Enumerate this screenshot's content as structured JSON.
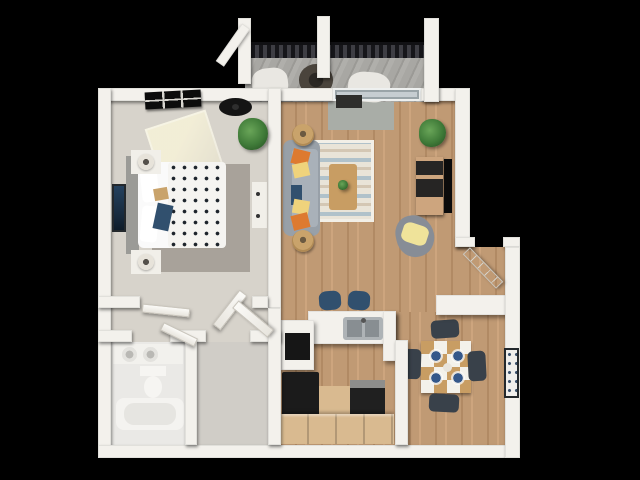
{
  "meta": {
    "type": "3d-floor-plan-render",
    "canvas": {
      "width": 640,
      "height": 480
    },
    "background": "#000000"
  },
  "rooms": [
    {
      "id": "bedroom"
    },
    {
      "id": "living-room"
    },
    {
      "id": "balcony"
    },
    {
      "id": "kitchen"
    },
    {
      "id": "dining-area"
    },
    {
      "id": "entry"
    },
    {
      "id": "hallway"
    },
    {
      "id": "bathroom"
    },
    {
      "id": "closet"
    }
  ],
  "palette": {
    "wall": "#f3f1ec",
    "wood": "#c09a74",
    "wood2": "#b18a64",
    "wood3": "#cda57e",
    "bedroomFloor": "#d7d3cb",
    "bathFloor": "#eae9e6",
    "closetFloor": "#d0cdc7",
    "rugGray": "#a8a29a",
    "sofaGray": "#98a0a8",
    "sofaSeat": "#a9b1b9",
    "accentOrange": "#dd7a30",
    "accentYellow": "#efd37c",
    "navy": "#31506e",
    "tan": "#c9a36b",
    "tableWood": "#c89d63",
    "chairDark": "#39414a",
    "plateBlue": "#35588a",
    "plantGreen": "#3f7a38",
    "applianceBlack": "#1b1b1b",
    "cabinetTan": "#d9ba90",
    "deckGray": "#a3a3a1"
  },
  "shapes": [
    {
      "name": "bedroom-floor",
      "x": 111,
      "y": 101,
      "w": 157,
      "h": 195,
      "fill": "var(--bedroomFloor)",
      "z": 1
    },
    {
      "name": "hallway-floor",
      "x": 111,
      "y": 296,
      "w": 157,
      "h": 46,
      "fill": "var(--bedroomFloor)",
      "z": 1
    },
    {
      "name": "bathroom-floor",
      "x": 111,
      "y": 342,
      "w": 86,
      "h": 103,
      "fill": "var(--bathFloor)",
      "z": 1
    },
    {
      "name": "closet-floor",
      "x": 185,
      "y": 342,
      "w": 96,
      "h": 103,
      "fill": "var(--closetFloor)",
      "z": 1
    },
    {
      "name": "living-room-floor",
      "x": 281,
      "y": 101,
      "w": 174,
      "h": 211,
      "cls": "wood",
      "z": 1
    },
    {
      "name": "kitchen-floor",
      "x": 281,
      "y": 312,
      "w": 114,
      "h": 133,
      "cls": "wood",
      "z": 1
    },
    {
      "name": "dining-floor",
      "x": 395,
      "y": 312,
      "w": 110,
      "h": 133,
      "cls": "wood",
      "z": 1
    },
    {
      "name": "entry-floor",
      "x": 455,
      "y": 247,
      "w": 50,
      "h": 65,
      "cls": "wood",
      "z": 1
    },
    {
      "name": "balcony-deck",
      "x": 245,
      "y": 50,
      "w": 183,
      "h": 52,
      "cls": "deck",
      "z": 1
    },
    {
      "name": "bedroom-rug",
      "x": 152,
      "y": 164,
      "w": 98,
      "h": 108,
      "fill": "var(--rugGray)",
      "z": 2
    },
    {
      "name": "sunlight-patch",
      "x": 152,
      "y": 118,
      "w": 64,
      "h": 58,
      "cls": "sun",
      "rot": -18,
      "z": 2
    },
    {
      "name": "balcony-door-mat",
      "x": 328,
      "y": 102,
      "w": 66,
      "h": 28,
      "fill": "#a9ada7",
      "z": 2
    },
    {
      "name": "living-rug",
      "x": 310,
      "y": 140,
      "w": 64,
      "h": 82,
      "cls": "rug",
      "z": 2
    },
    {
      "name": "balcony-railing",
      "x": 243,
      "y": 42,
      "w": 187,
      "h": 16,
      "cls": "railing",
      "z": 2
    },
    {
      "name": "patio-chair-left",
      "x": 252,
      "y": 68,
      "w": 36,
      "h": 30,
      "fill": "#e9e7e2",
      "rad": "40%",
      "rot": -6,
      "z": 3
    },
    {
      "name": "patio-chair-right",
      "x": 348,
      "y": 72,
      "w": 42,
      "h": 30,
      "fill": "#e9e7e2",
      "rad": "40%",
      "rot": 5,
      "z": 3
    },
    {
      "name": "patio-table",
      "x": 299,
      "y": 64,
      "w": 34,
      "h": 32,
      "cls": "wicker",
      "z": 3
    },
    {
      "name": "bed-headboard",
      "x": 126,
      "y": 156,
      "w": 13,
      "h": 98,
      "fill": "#9b9b97",
      "z": 3
    },
    {
      "name": "bed",
      "x": 138,
      "y": 162,
      "w": 88,
      "h": 86,
      "fill": "#fafafa",
      "rad": "6px",
      "z": 3
    },
    {
      "name": "bed-duvet-polka",
      "x": 168,
      "y": 162,
      "w": 58,
      "h": 86,
      "cls": "polka",
      "z": 3
    },
    {
      "name": "bed-pillow-top",
      "x": 141,
      "y": 166,
      "w": 17,
      "h": 36,
      "fill": "#ffffff",
      "rot": -6,
      "rad": "4px",
      "z": 3
    },
    {
      "name": "bed-pillow-bottom",
      "x": 141,
      "y": 206,
      "w": 17,
      "h": 36,
      "fill": "#ffffff",
      "rot": 5,
      "rad": "4px",
      "z": 3
    },
    {
      "name": "bed-throw-tan",
      "x": 154,
      "y": 188,
      "w": 14,
      "h": 12,
      "fill": "var(--tan)",
      "rot": -10,
      "z": 3
    },
    {
      "name": "bed-throw-navy",
      "x": 155,
      "y": 204,
      "w": 16,
      "h": 26,
      "fill": "var(--navy)",
      "rot": 12,
      "z": 3
    },
    {
      "name": "nightstand-top",
      "x": 131,
      "y": 150,
      "w": 30,
      "h": 24,
      "fill": "#f1efe9",
      "z": 3
    },
    {
      "name": "nightstand-bottom",
      "x": 131,
      "y": 250,
      "w": 30,
      "h": 24,
      "fill": "#f1efe9",
      "z": 3
    },
    {
      "name": "lamp-top",
      "x": 138,
      "y": 154,
      "w": 16,
      "h": 16,
      "cls": "lamp",
      "z": 4
    },
    {
      "name": "lamp-bottom",
      "x": 138,
      "y": 254,
      "w": 16,
      "h": 16,
      "cls": "lamp",
      "z": 4
    },
    {
      "name": "bedroom-dresser",
      "x": 252,
      "y": 182,
      "w": 15,
      "h": 46,
      "fill": "#f1efe9",
      "z": 3
    },
    {
      "name": "dresser-knob-1",
      "x": 256,
      "y": 192,
      "w": 4,
      "h": 4,
      "fill": "#333333",
      "rad": "50%",
      "z": 4
    },
    {
      "name": "dresser-knob-2",
      "x": 256,
      "y": 214,
      "w": 4,
      "h": 4,
      "fill": "#333333",
      "rad": "50%",
      "z": 4
    },
    {
      "name": "sofa",
      "x": 283,
      "y": 140,
      "w": 37,
      "h": 96,
      "fill": "var(--sofaGray)",
      "rad": "8px",
      "z": 3
    },
    {
      "name": "sofa-seat",
      "x": 292,
      "y": 149,
      "w": 26,
      "h": 78,
      "fill": "var(--sofaSeat)",
      "rad": "4px",
      "z": 3
    },
    {
      "name": "sofa-pillow-orange-1",
      "x": 292,
      "y": 150,
      "w": 17,
      "h": 15,
      "fill": "var(--accentOrange)",
      "rot": 14,
      "z": 3
    },
    {
      "name": "sofa-pillow-yellow-1",
      "x": 293,
      "y": 163,
      "w": 16,
      "h": 14,
      "fill": "var(--accentYellow)",
      "rot": -12,
      "z": 3
    },
    {
      "name": "sofa-pillow-navy",
      "x": 291,
      "y": 185,
      "w": 11,
      "h": 20,
      "fill": "var(--navy)",
      "z": 3
    },
    {
      "name": "sofa-pillow-yellow-2",
      "x": 293,
      "y": 200,
      "w": 16,
      "h": 14,
      "fill": "var(--accentYellow)",
      "rot": 10,
      "z": 3
    },
    {
      "name": "sofa-pillow-orange-2",
      "x": 292,
      "y": 214,
      "w": 17,
      "h": 15,
      "fill": "var(--accentOrange)",
      "rot": -14,
      "z": 3
    },
    {
      "name": "rattan-pouf-top",
      "x": 292,
      "y": 124,
      "w": 22,
      "h": 22,
      "cls": "pouf",
      "z": 3
    },
    {
      "name": "rattan-pouf-bottom",
      "x": 292,
      "y": 230,
      "w": 22,
      "h": 22,
      "cls": "pouf",
      "z": 3
    },
    {
      "name": "coffee-table",
      "x": 329,
      "y": 164,
      "w": 28,
      "h": 46,
      "fill": "var(--tableWood)",
      "rad": "3px",
      "z": 3
    },
    {
      "name": "coffee-table-plant",
      "x": 338,
      "y": 180,
      "w": 10,
      "h": 10,
      "cls": "plant",
      "z": 4
    },
    {
      "name": "tv-console",
      "x": 416,
      "y": 157,
      "w": 27,
      "h": 58,
      "cls": "console",
      "z": 3
    },
    {
      "name": "tv",
      "x": 444,
      "y": 159,
      "w": 8,
      "h": 54,
      "fill": "#0b0b0b",
      "z": 3
    },
    {
      "name": "bean-bag",
      "x": 396,
      "y": 215,
      "w": 38,
      "h": 42,
      "fill": "#878d96",
      "rad": "45% 55% 50% 50%",
      "rot": -12,
      "z": 3
    },
    {
      "name": "bean-bag-blanket",
      "x": 402,
      "y": 224,
      "w": 26,
      "h": 20,
      "fill": "#efe39a",
      "rad": "30%",
      "rot": 18,
      "z": 3
    },
    {
      "name": "breakfast-bar",
      "x": 308,
      "y": 311,
      "w": 88,
      "h": 33,
      "cls": "counter",
      "z": 3
    },
    {
      "name": "kitchen-sink",
      "x": 343,
      "y": 317,
      "w": 40,
      "h": 23,
      "fill": "#aeb3b6",
      "rad": "3px",
      "z": 4
    },
    {
      "name": "sink-basin-left",
      "x": 347,
      "y": 320,
      "w": 15,
      "h": 17,
      "fill": "#888e92",
      "z": 5
    },
    {
      "name": "sink-basin-right",
      "x": 365,
      "y": 320,
      "w": 14,
      "h": 17,
      "fill": "#888e92",
      "z": 5
    },
    {
      "name": "sink-faucet",
      "x": 361,
      "y": 318,
      "w": 5,
      "h": 5,
      "fill": "#555555",
      "rad": "50%",
      "z": 5
    },
    {
      "name": "bar-stool-1",
      "x": 319,
      "y": 291,
      "w": 22,
      "h": 19,
      "fill": "var(--navy)",
      "rad": "35%",
      "rot": -4,
      "z": 3
    },
    {
      "name": "bar-stool-2",
      "x": 348,
      "y": 291,
      "w": 22,
      "h": 19,
      "fill": "var(--navy)",
      "rad": "35%",
      "rot": 4,
      "z": 3
    },
    {
      "name": "kitchen-cabinet-left",
      "x": 281,
      "y": 320,
      "w": 33,
      "h": 50,
      "cls": "counter",
      "z": 3
    },
    {
      "name": "built-in-oven",
      "x": 285,
      "y": 333,
      "w": 25,
      "h": 27,
      "fill": "#161616",
      "z": 4
    },
    {
      "name": "counter-return",
      "x": 383,
      "y": 311,
      "w": 13,
      "h": 50,
      "cls": "counter",
      "z": 3
    },
    {
      "name": "refrigerator",
      "x": 282,
      "y": 372,
      "w": 37,
      "h": 52,
      "fill": "var(--applianceBlack)",
      "rad": "2px",
      "z": 3
    },
    {
      "name": "kitchen-cabinet-mid",
      "x": 319,
      "y": 386,
      "w": 31,
      "h": 38,
      "fill": "var(--cabinetTan)",
      "z": 3
    },
    {
      "name": "stove",
      "x": 350,
      "y": 380,
      "w": 35,
      "h": 45,
      "fill": "#202020",
      "z": 3
    },
    {
      "name": "stove-control-band",
      "x": 350,
      "y": 380,
      "w": 35,
      "h": 8,
      "fill": "#8e8e8c",
      "z": 4
    },
    {
      "name": "kitchen-cabinet-row",
      "x": 281,
      "y": 414,
      "w": 113,
      "h": 30,
      "cls": "cabinets",
      "z": 4
    },
    {
      "name": "dining-table",
      "x": 421,
      "y": 341,
      "w": 50,
      "h": 52,
      "cls": "checker",
      "z": 3
    },
    {
      "name": "plate-1",
      "x": 430,
      "y": 350,
      "w": 12,
      "h": 12,
      "cls": "plate",
      "z": 4
    },
    {
      "name": "plate-2",
      "x": 452,
      "y": 350,
      "w": 12,
      "h": 12,
      "cls": "plate",
      "z": 4
    },
    {
      "name": "plate-3",
      "x": 430,
      "y": 372,
      "w": 12,
      "h": 12,
      "cls": "plate",
      "z": 4
    },
    {
      "name": "plate-4",
      "x": 452,
      "y": 372,
      "w": 12,
      "h": 12,
      "cls": "plate",
      "z": 4
    },
    {
      "name": "table-centerpiece",
      "x": 443,
      "y": 363,
      "w": 9,
      "h": 9,
      "fill": "#e8e4dc",
      "rad": "50%",
      "z": 4
    },
    {
      "name": "dining-chair-top",
      "x": 431,
      "y": 320,
      "w": 28,
      "h": 18,
      "fill": "var(--chairDark)",
      "rad": "5px",
      "rot": -4,
      "z": 3
    },
    {
      "name": "dining-chair-bottom",
      "x": 429,
      "y": 394,
      "w": 30,
      "h": 18,
      "fill": "var(--chairDark)",
      "rad": "5px",
      "rot": 3,
      "z": 3
    },
    {
      "name": "dining-chair-left",
      "x": 403,
      "y": 349,
      "w": 18,
      "h": 30,
      "fill": "var(--chairDark)",
      "rad": "5px",
      "rot": 2,
      "z": 3
    },
    {
      "name": "dining-chair-right",
      "x": 468,
      "y": 351,
      "w": 18,
      "h": 30,
      "fill": "var(--chairDark)",
      "rad": "5px",
      "rot": -3,
      "z": 3
    },
    {
      "name": "entry-console",
      "x": 436,
      "y": 295,
      "w": 84,
      "h": 20,
      "cls": "counter",
      "z": 3
    },
    {
      "name": "bathroom-vanity",
      "x": 113,
      "y": 344,
      "w": 70,
      "h": 20,
      "fill": "#f2f1ed",
      "z": 3
    },
    {
      "name": "vanity-sink-1",
      "x": 122,
      "y": 347,
      "w": 15,
      "h": 15,
      "cls": "basinround",
      "z": 4
    },
    {
      "name": "vanity-sink-2",
      "x": 143,
      "y": 347,
      "w": 15,
      "h": 15,
      "cls": "basinround",
      "z": 4
    },
    {
      "name": "toilet-tank",
      "x": 140,
      "y": 366,
      "w": 26,
      "h": 10,
      "fill": "#f6f5f2",
      "z": 3
    },
    {
      "name": "toilet-bowl",
      "x": 144,
      "y": 376,
      "w": 18,
      "h": 22,
      "fill": "#f6f5f2",
      "rad": "50%",
      "z": 3
    },
    {
      "name": "bathtub",
      "x": 116,
      "y": 398,
      "w": 68,
      "h": 32,
      "fill": "#f4f3f0",
      "rad": "8px",
      "z": 3
    },
    {
      "name": "bathtub-inner",
      "x": 124,
      "y": 403,
      "w": 52,
      "h": 22,
      "fill": "#e6e5e1",
      "rad": "10px",
      "z": 4
    },
    {
      "name": "wall-top-left",
      "x": 98,
      "y": 88,
      "w": 235,
      "h": 13,
      "cls": "wall",
      "z": 4
    },
    {
      "name": "balcony-sliding-door",
      "x": 333,
      "y": 88,
      "w": 88,
      "h": 13,
      "cls": "glass",
      "z": 4
    },
    {
      "name": "wall-top-right",
      "x": 421,
      "y": 88,
      "w": 49,
      "h": 13,
      "cls": "wall",
      "z": 4
    },
    {
      "name": "wall-left",
      "x": 98,
      "y": 88,
      "w": 13,
      "h": 370,
      "cls": "wall",
      "z": 4
    },
    {
      "name": "wall-bottom",
      "x": 98,
      "y": 445,
      "w": 422,
      "h": 13,
      "cls": "wall",
      "z": 4
    },
    {
      "name": "wall-right-upper",
      "x": 455,
      "y": 88,
      "w": 15,
      "h": 159,
      "cls": "wall",
      "z": 4
    },
    {
      "name": "wall-entry-left",
      "x": 455,
      "y": 237,
      "w": 20,
      "h": 10,
      "cls": "wall",
      "z": 4
    },
    {
      "name": "wall-entry-right",
      "x": 503,
      "y": 237,
      "w": 17,
      "h": 10,
      "cls": "wall",
      "z": 4
    },
    {
      "name": "wall-right-lower",
      "x": 505,
      "y": 247,
      "w": 15,
      "h": 211,
      "cls": "wall",
      "z": 4
    },
    {
      "name": "wall-bedroom-divider",
      "x": 268,
      "y": 88,
      "w": 13,
      "h": 220,
      "cls": "wall",
      "z": 4
    },
    {
      "name": "wall-bedroom-bottom-a",
      "x": 98,
      "y": 296,
      "w": 42,
      "h": 12,
      "cls": "wall",
      "z": 4
    },
    {
      "name": "wall-bedroom-bottom-b",
      "x": 252,
      "y": 296,
      "w": 16,
      "h": 12,
      "cls": "wall",
      "z": 4
    },
    {
      "name": "wall-hall-bottom-a",
      "x": 98,
      "y": 330,
      "w": 34,
      "h": 12,
      "cls": "wall",
      "z": 4
    },
    {
      "name": "wall-hall-bottom-b",
      "x": 170,
      "y": 330,
      "w": 36,
      "h": 12,
      "cls": "wall",
      "z": 4
    },
    {
      "name": "wall-hall-bottom-c",
      "x": 250,
      "y": 330,
      "w": 31,
      "h": 12,
      "cls": "wall",
      "z": 4
    },
    {
      "name": "wall-bath-closet-divider",
      "x": 185,
      "y": 342,
      "w": 12,
      "h": 103,
      "cls": "wall",
      "z": 4
    },
    {
      "name": "wall-closet-kitchen",
      "x": 268,
      "y": 308,
      "w": 13,
      "h": 137,
      "cls": "wall",
      "z": 4
    },
    {
      "name": "wall-kitchen-dining",
      "x": 395,
      "y": 340,
      "w": 13,
      "h": 105,
      "cls": "wall",
      "z": 4
    },
    {
      "name": "balcony-post-left",
      "x": 238,
      "y": 18,
      "w": 13,
      "h": 66,
      "cls": "wall",
      "z": 4
    },
    {
      "name": "balcony-post-mid",
      "x": 317,
      "y": 16,
      "w": 13,
      "h": 62,
      "cls": "wall",
      "z": 4
    },
    {
      "name": "balcony-wall-right",
      "x": 424,
      "y": 18,
      "w": 15,
      "h": 84,
      "cls": "wall",
      "z": 4
    },
    {
      "name": "balcony-beam",
      "x": 228,
      "y": 22,
      "w": 10,
      "h": 46,
      "cls": "wall",
      "rot": 35,
      "z": 4
    },
    {
      "name": "door-bedroom-leaf-a",
      "x": 142,
      "y": 306,
      "w": 48,
      "h": 9,
      "cls": "door",
      "rot": 6,
      "z": 5
    },
    {
      "name": "door-bedroom-leaf-b",
      "x": 225,
      "y": 288,
      "w": 10,
      "h": 44,
      "cls": "door",
      "rot": 38,
      "z": 5
    },
    {
      "name": "door-bathroom",
      "x": 160,
      "y": 330,
      "w": 38,
      "h": 9,
      "cls": "door",
      "rot": 26,
      "z": 5
    },
    {
      "name": "door-closet",
      "x": 248,
      "y": 296,
      "w": 10,
      "h": 46,
      "cls": "door",
      "rot": -50,
      "z": 5
    },
    {
      "name": "door-front",
      "x": 478,
      "y": 244,
      "w": 10,
      "h": 48,
      "cls": "door doorpanel",
      "rot": -44,
      "z": 5
    },
    {
      "name": "bedroom-window",
      "x": 145,
      "y": 91,
      "w": 56,
      "h": 17,
      "cls": "windowgrid",
      "rot": -3,
      "z": 5
    },
    {
      "name": "ceiling-fan",
      "x": 219,
      "y": 98,
      "w": 33,
      "h": 18,
      "fill": "#141414",
      "rad": "50%",
      "z": 5
    },
    {
      "name": "ceiling-fan-hub",
      "x": 232,
      "y": 104,
      "w": 7,
      "h": 6,
      "fill": "#2e2e2e",
      "rad": "50%",
      "z": 6
    },
    {
      "name": "balcony-threshold-grill",
      "x": 336,
      "y": 95,
      "w": 26,
      "h": 13,
      "fill": "#2e2e2c",
      "z": 5
    },
    {
      "name": "bedroom-wall-art",
      "x": 112,
      "y": 184,
      "w": 14,
      "h": 48,
      "cls": "art-navy",
      "z": 5
    },
    {
      "name": "dining-wall-art",
      "x": 504,
      "y": 348,
      "w": 15,
      "h": 50,
      "cls": "art-bot",
      "z": 5
    },
    {
      "name": "plant-bedroom-corner",
      "x": 238,
      "y": 118,
      "w": 30,
      "h": 32,
      "cls": "plant",
      "z": 5
    },
    {
      "name": "plant-living-corner",
      "x": 419,
      "y": 119,
      "w": 27,
      "h": 28,
      "cls": "plant",
      "z": 5
    }
  ]
}
